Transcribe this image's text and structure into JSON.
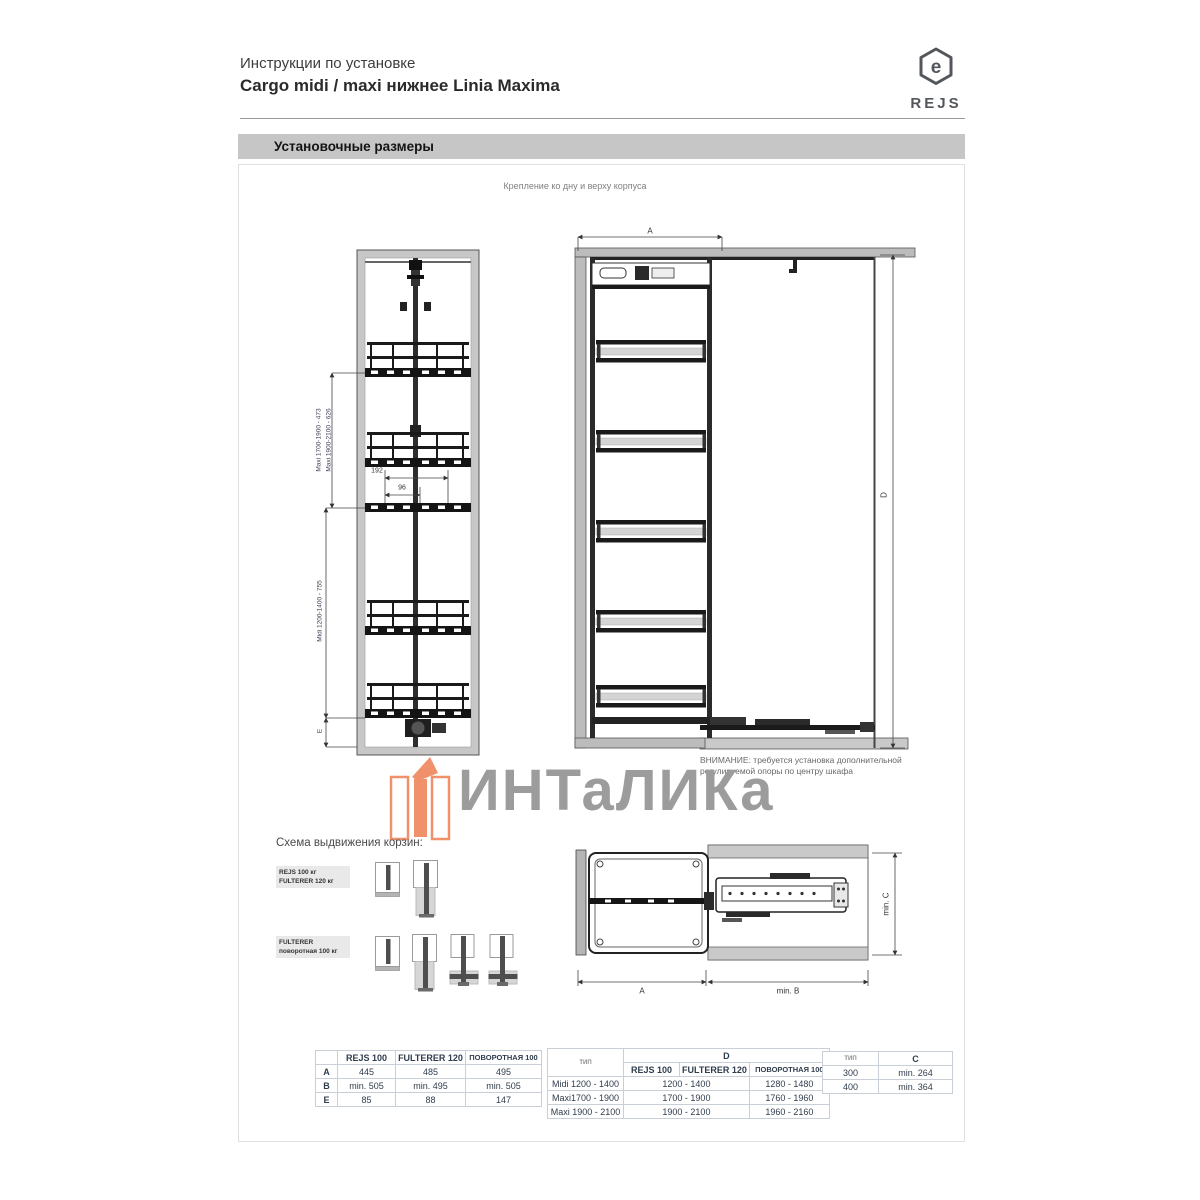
{
  "header": {
    "doc_type": "Инструкции по установке",
    "product_title": "Cargo midi / maxi нижнее Linia Maxima",
    "brand": "REJS"
  },
  "section_bar": {
    "title": "Установочные размеры"
  },
  "drawings": {
    "caption": "Крепление ко дну и верху корпуса",
    "warning_line1": "ВНИМАНИЕ: требуется установка дополнительной",
    "warning_line2": "регулируемой опоры по центру шкафа",
    "front_left": {
      "dim_maxi_1": "Maxi 1700-1900 - 473",
      "dim_maxi_2": "Maxi 1900-2100 - 626",
      "dim_midi": "Midi 1200-1400 - 755",
      "dim_e": "E",
      "dim_width_outer": "192",
      "dim_width_inner": "96"
    },
    "front_right": {
      "dim_a": "A",
      "dim_d": "D"
    },
    "top_view": {
      "dim_a": "A",
      "dim_b": "min. B",
      "dim_c": "min. C"
    }
  },
  "watermark": {
    "text": "ИНТаЛИКа"
  },
  "scheme": {
    "title": "Схема выдвижения корзин:",
    "labels": [
      {
        "line1": "REJS 100 кг",
        "line2": "FULTERER 120 кг"
      },
      {
        "line1": "FULTERER",
        "line2": "поворотная 100 кг"
      }
    ]
  },
  "tables": {
    "t1": {
      "headers": [
        "",
        "REJS 100",
        "FULTERER 120",
        "ПОВОРОТНАЯ 100"
      ],
      "rows": [
        [
          "A",
          "445",
          "485",
          "495"
        ],
        [
          "B",
          "min. 505",
          "min. 495",
          "min. 505"
        ],
        [
          "E",
          "85",
          "88",
          "147"
        ]
      ]
    },
    "t2": {
      "corner": "ТИП",
      "span_header": "D",
      "sub_headers": [
        "REJS 100",
        "FULTERER 120",
        "ПОВОРОТНАЯ 100"
      ],
      "rows": [
        [
          "Midi 1200 - 1400",
          "1200 - 1400",
          "1280 - 1480"
        ],
        [
          "Maxi1700 - 1900",
          "1700 - 1900",
          "1760 - 1960"
        ],
        [
          "Maxi 1900 - 2100",
          "1900 - 2100",
          "1960 - 2160"
        ]
      ]
    },
    "t3": {
      "headers": [
        "ТИП",
        "C"
      ],
      "rows": [
        [
          "300",
          "min. 264"
        ],
        [
          "400",
          "min. 364"
        ]
      ]
    }
  }
}
